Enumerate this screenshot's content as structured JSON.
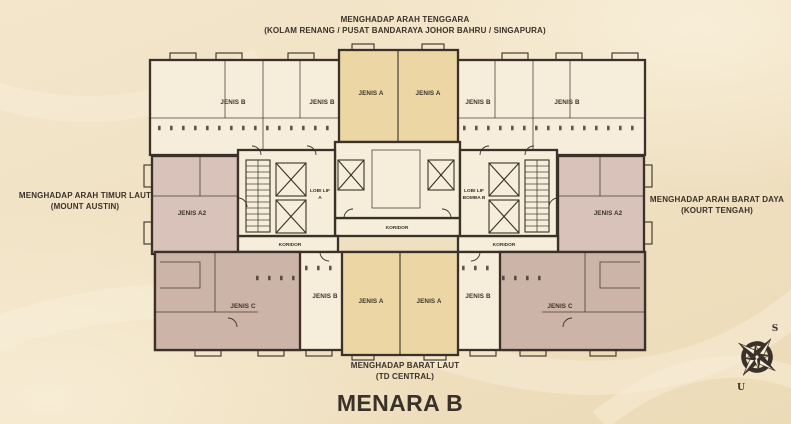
{
  "page": {
    "title": "MENARA B"
  },
  "orientation_labels": {
    "top": {
      "line1": "MENGHADAP ARAH TENGGARA",
      "line2": "(KOLAM RENANG / PUSAT BANDARAYA JOHOR BAHRU  / SINGAPURA)"
    },
    "left": {
      "line1": "MENGHADAP ARAH TIMUR LAUT",
      "line2": "(MOUNT AUSTIN)"
    },
    "right": {
      "line1": "MENGHADAP ARAH BARAT DAYA",
      "line2": "(KOURT TENGAH)"
    },
    "bottom": {
      "line1": "MENGHADAP BARAT LAUT",
      "line2": "(TD CENTRAL)"
    }
  },
  "units": {
    "top_row": [
      {
        "label": "JENIS B"
      },
      {
        "label": "JENIS B"
      },
      {
        "label": "JENIS A"
      },
      {
        "label": "JENIS A"
      },
      {
        "label": "JENIS B"
      },
      {
        "label": "JENIS B"
      }
    ],
    "middle_row": [
      {
        "label": "JENIS A2"
      },
      {
        "label": "JENIS A2"
      }
    ],
    "bottom_row": [
      {
        "label": "JENIS C"
      },
      {
        "label": "JENIS B"
      },
      {
        "label": "JENIS A"
      },
      {
        "label": "JENIS A"
      },
      {
        "label": "JENIS B"
      },
      {
        "label": "JENIS C"
      }
    ]
  },
  "core": {
    "lobby_a": {
      "line1": "LOBI LIF",
      "line2": "A"
    },
    "lobby_b": {
      "line1": "LOBI LIF",
      "line2": "BOMBA B"
    },
    "corridor_center": "KORIDOR",
    "corridor_left": "KORIDOR",
    "corridor_right": "KORIDOR"
  },
  "compass": {
    "south_label": "S",
    "north_label": "U"
  },
  "colors": {
    "background": "#f0e1c3",
    "wall": "#3a3129",
    "unit_default": "#f6eedb",
    "unit_a": "#ecd7a4",
    "unit_a2": "#d9c2b9",
    "unit_c": "#ccb4a9",
    "text": "#3a3129"
  }
}
